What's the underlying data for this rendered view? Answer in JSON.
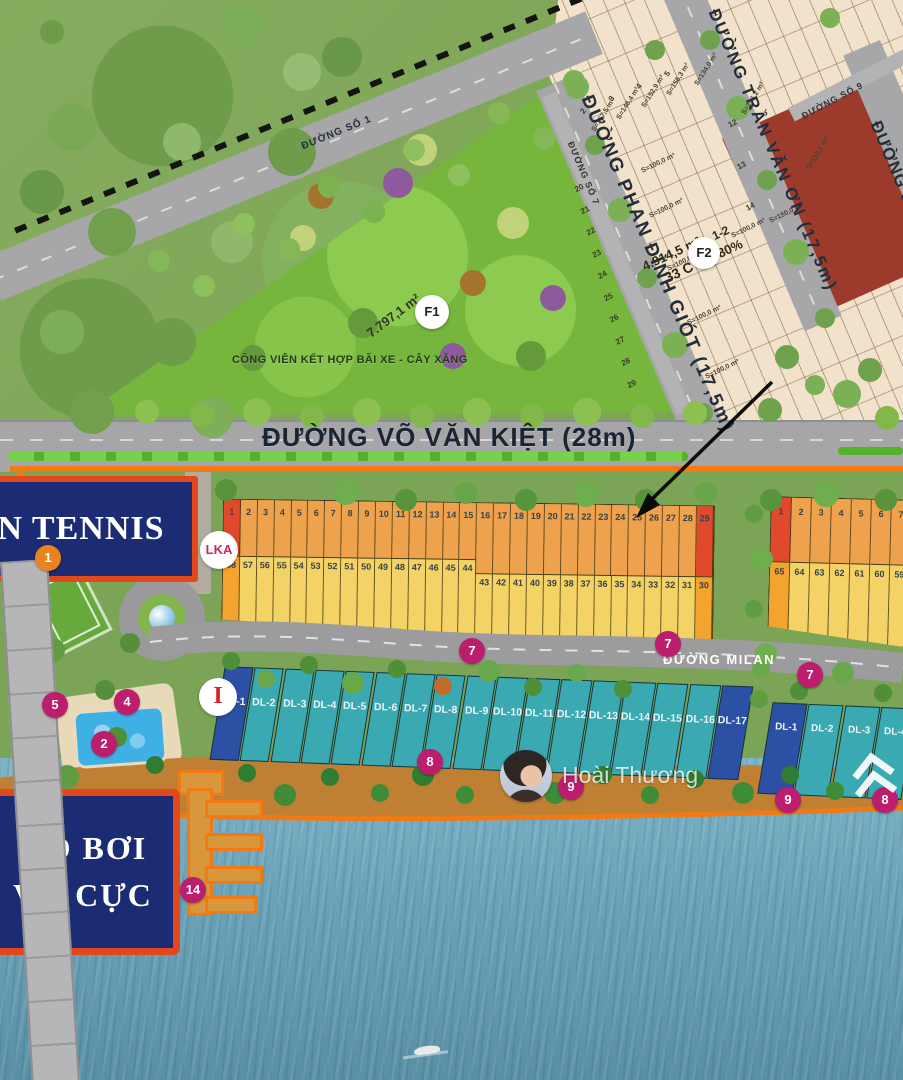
{
  "park": {
    "name": "CÔNG VIÊN KẾT HỢP BÃI XE - CÂY XĂNG",
    "area": "7.797,1 m²",
    "marker": "F1"
  },
  "streets": {
    "so1": "ĐƯỜNG SỐ 1",
    "phan_dinh_giot": "ĐƯỜNG PHAN ĐÌNH GIÓT (17,5m)",
    "tran_van_on": "ĐƯỜNG TRẦN VĂN ƠN (17,5m)",
    "so7": "ĐƯỜNG SỐ 7",
    "so9": "ĐƯỜNG SỐ 9",
    "duong_d": "ĐƯỜNG D",
    "vo_van_kiet": "ĐƯỜNG VÕ VĂN KIỆT (28m)",
    "milan": "ĐƯỜNG MILAN"
  },
  "f2_block": {
    "marker": "F2",
    "area": "4.914,5 m²",
    "code": "33 C",
    "lots": "1-2",
    "ratio": "80%"
  },
  "plot_areas": [
    "S=157,5 m²",
    "S=146,4 m²",
    "S=152,9 m²",
    "S=156,3 m²",
    "S=134,0 m²",
    "S=100,0 m²",
    "S=100,0 m²",
    "S=100,0 m²",
    "S=100,0 m²",
    "S=100,0 m²",
    "S=100,0 m²",
    "S=110,1 m²",
    "S=236,2 m²",
    "S=150,0 m²"
  ],
  "plot_numbers": {
    "wedge": [
      "2",
      "3",
      "4",
      "5"
    ],
    "left_col": [
      "20",
      "21",
      "22",
      "23",
      "24",
      "25",
      "26",
      "27",
      "28",
      "29"
    ],
    "right_col": [
      "12",
      "13",
      "14"
    ]
  },
  "amenities": {
    "tennis": "N TENNIS",
    "pool_line1": "HỒ BƠI",
    "pool_line2": "VÔ CỰC"
  },
  "badges": {
    "lka": "LKA",
    "gate": "I"
  },
  "lots": {
    "blockA_row1": [
      {
        "n": "1",
        "cls": "red"
      },
      {
        "n": "2"
      },
      {
        "n": "3"
      },
      {
        "n": "4"
      },
      {
        "n": "5"
      },
      {
        "n": "6"
      },
      {
        "n": "7"
      },
      {
        "n": "8"
      },
      {
        "n": "9"
      },
      {
        "n": "10"
      },
      {
        "n": "11"
      },
      {
        "n": "12"
      },
      {
        "n": "13"
      },
      {
        "n": "14"
      },
      {
        "n": "15"
      },
      {
        "n": "16"
      },
      {
        "n": "17"
      },
      {
        "n": "18"
      },
      {
        "n": "19"
      },
      {
        "n": "20"
      },
      {
        "n": "21"
      },
      {
        "n": "22"
      },
      {
        "n": "23"
      },
      {
        "n": "24"
      },
      {
        "n": "25"
      },
      {
        "n": "26"
      },
      {
        "n": "27"
      },
      {
        "n": "28"
      },
      {
        "n": "29",
        "cls": "red"
      }
    ],
    "blockA_row2_left": [
      {
        "n": "58",
        "cls": "hl"
      },
      {
        "n": "57"
      },
      {
        "n": "56"
      },
      {
        "n": "55"
      },
      {
        "n": "54"
      },
      {
        "n": "53"
      },
      {
        "n": "52"
      },
      {
        "n": "51"
      },
      {
        "n": "50"
      },
      {
        "n": "49"
      },
      {
        "n": "48"
      },
      {
        "n": "47"
      },
      {
        "n": "46"
      },
      {
        "n": "45"
      },
      {
        "n": "44"
      }
    ],
    "blockA_row2_right": [
      {
        "n": "43"
      },
      {
        "n": "42"
      },
      {
        "n": "41"
      },
      {
        "n": "40"
      },
      {
        "n": "39"
      },
      {
        "n": "38"
      },
      {
        "n": "37"
      },
      {
        "n": "36"
      },
      {
        "n": "35"
      },
      {
        "n": "34"
      },
      {
        "n": "33"
      },
      {
        "n": "32"
      },
      {
        "n": "31"
      },
      {
        "n": "30",
        "cls": "hl"
      }
    ],
    "blockB_row1": [
      {
        "n": "1",
        "cls": "red"
      },
      {
        "n": "2"
      },
      {
        "n": "3"
      },
      {
        "n": "4"
      },
      {
        "n": "5"
      },
      {
        "n": "6"
      },
      {
        "n": "7"
      }
    ],
    "blockB_row2": [
      {
        "n": "65",
        "cls": "hl"
      },
      {
        "n": "64"
      },
      {
        "n": "63"
      },
      {
        "n": "62"
      },
      {
        "n": "61"
      },
      {
        "n": "60"
      },
      {
        "n": "59"
      }
    ],
    "dl_row": [
      {
        "n": "DL-1",
        "cls": "dark"
      },
      {
        "n": "DL-2"
      },
      {
        "n": "DL-3"
      },
      {
        "n": "DL-4"
      },
      {
        "n": "DL-5"
      },
      {
        "n": "DL-6"
      },
      {
        "n": "DL-7"
      },
      {
        "n": "DL-8"
      },
      {
        "n": "DL-9"
      },
      {
        "n": "DL-10"
      },
      {
        "n": "DL-11"
      },
      {
        "n": "DL-12"
      },
      {
        "n": "DL-13"
      },
      {
        "n": "DL-14"
      },
      {
        "n": "DL-15"
      },
      {
        "n": "DL-16"
      },
      {
        "n": "DL-17",
        "cls": "dark"
      }
    ],
    "dl_right": [
      {
        "n": "DL-1",
        "cls": "dark"
      },
      {
        "n": "DL-2"
      },
      {
        "n": "DL-3"
      },
      {
        "n": "DL-4"
      }
    ]
  },
  "markers": [
    "1",
    "3",
    "5",
    "4",
    "2",
    "7",
    "7",
    "7",
    "8",
    "9",
    "9",
    "8",
    "14"
  ],
  "watermark": {
    "name": "Hoài Thương"
  },
  "colors": {
    "boundary_orange": "#ef7a16",
    "lot_orange": "#efa24d",
    "lot_yellow": "#f3d266",
    "lot_red": "#e0492b",
    "lot_teal": "#3ba9b1",
    "lot_navy": "#2c50a3",
    "marker_magenta": "#bc1d6d",
    "label_navy_box": "#1b2b74"
  }
}
